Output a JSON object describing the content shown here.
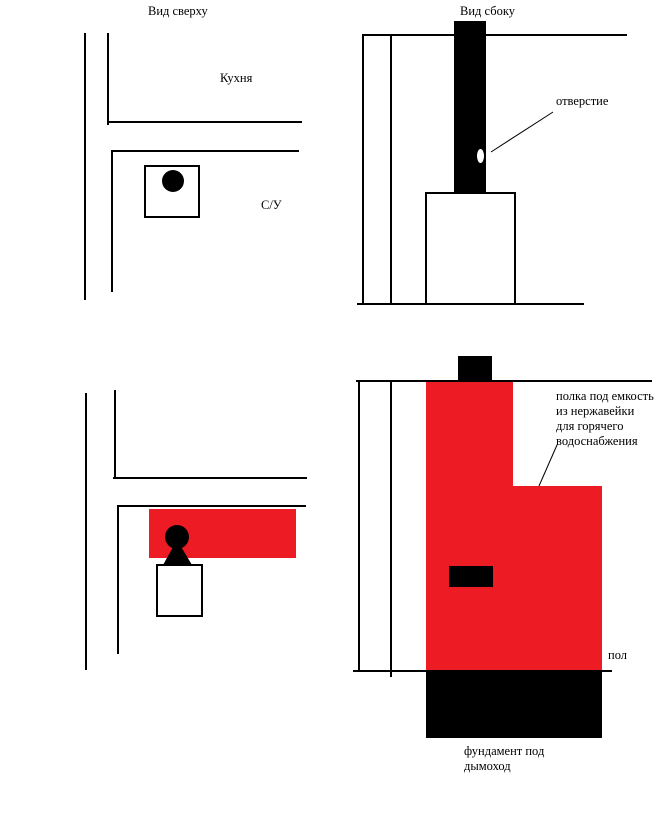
{
  "colors": {
    "accent_red": "#ED1C24",
    "ink_black": "#000000",
    "background": "#FFFFFF"
  },
  "figures": {
    "top_view_upper": {
      "title": "Вид сверху",
      "kitchen_label": "Кухня",
      "bathroom_label": "С/У"
    },
    "side_view_upper": {
      "title": "Вид сбоку",
      "hole_label": "отверстие"
    },
    "top_view_lower": {},
    "side_view_lower": {
      "shelf_label_lines": [
        "полка под емкость",
        "из нержавейки",
        "для горячего",
        "водоснабжения"
      ],
      "floor_label": "пол",
      "foundation_label_lines": [
        "фундамент под",
        "дымоход"
      ]
    }
  }
}
